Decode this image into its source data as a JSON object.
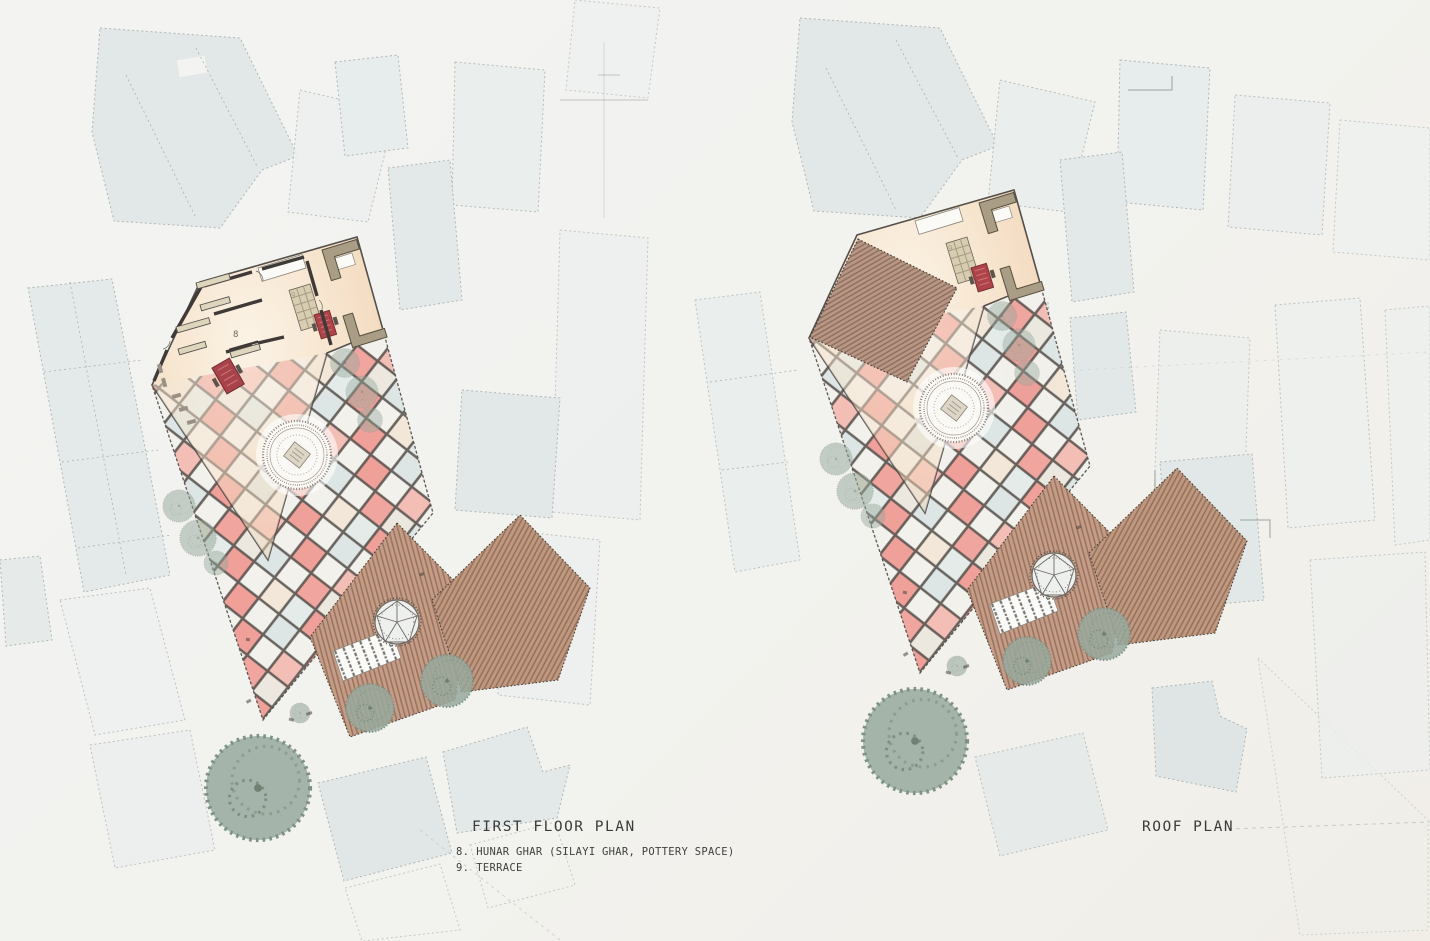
{
  "document": {
    "type": "architectural-site-plan-sheet",
    "background": "#f2f3f0"
  },
  "plans": [
    {
      "id": "first-floor",
      "title": "FIRST FLOOR PLAN",
      "legend": [
        {
          "num": "8.",
          "label": "HUNAR GHAR (SILAYI GHAR, POTTERY SPACE)"
        },
        {
          "num": "9.",
          "label": "TERRACE"
        }
      ],
      "room_labels": {
        "hunar_ghar": "8",
        "terrace": "9"
      }
    },
    {
      "id": "roof",
      "title": "ROOF PLAN",
      "legend": [],
      "room_labels": {
        "terrace": "9"
      }
    }
  ],
  "palette": {
    "paper": "#f2f3f0",
    "context_building": "#e2e8e7",
    "context_building_light": "#ecefee",
    "context_outline": "#aeb7b5",
    "tile_grid_line": "#524c48",
    "tile_pink": "#ee9e97",
    "tile_pink_light": "#f4bdb5",
    "tile_blue": "#dde6e4",
    "tile_white": "#f3f1ec",
    "interior_cream": "#f9efe0",
    "interior_peach": "#efd2b4",
    "roof_brown": "#c59c86",
    "roof_hatch": "#97725e",
    "wall_dark": "#3f3a37",
    "table_red": "#ab4149",
    "bench_beige": "#ded5bd",
    "sofa_taupe": "#a99d85",
    "tree_green": "#98a99d",
    "text": "#3a3a39"
  }
}
